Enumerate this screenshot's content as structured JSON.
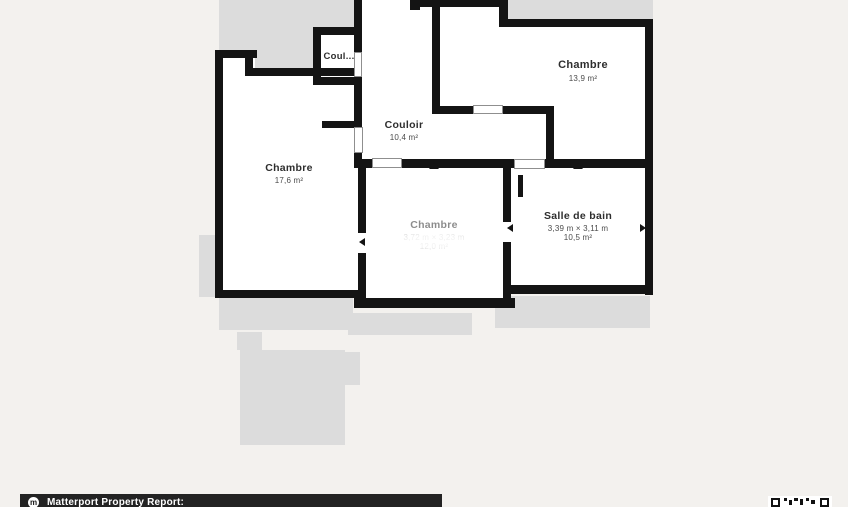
{
  "floorplan": {
    "colors": {
      "wall": "#141414",
      "backdrop": "#dcdcdc",
      "room_fill": "#ffffff",
      "page_bg": "#f3f1ee"
    },
    "rooms": [
      {
        "name": "Coul...",
        "dimensions": "",
        "area": ""
      },
      {
        "name": "Chambre",
        "dimensions": "",
        "area": "13,9 m²"
      },
      {
        "name": "Couloir",
        "dimensions": "",
        "area": "10,4 m²"
      },
      {
        "name": "Chambre",
        "dimensions": "",
        "area": "17,6 m²"
      },
      {
        "name": "Chambre",
        "dimensions": "3,72 m × 3,23 m",
        "area": "12,0 m²"
      },
      {
        "name": "Salle de bain",
        "dimensions": "3,39 m × 3,11 m",
        "area": "10,5 m²"
      }
    ]
  },
  "footer": {
    "label": "Matterport Property Report:",
    "logo_letter": "m"
  }
}
